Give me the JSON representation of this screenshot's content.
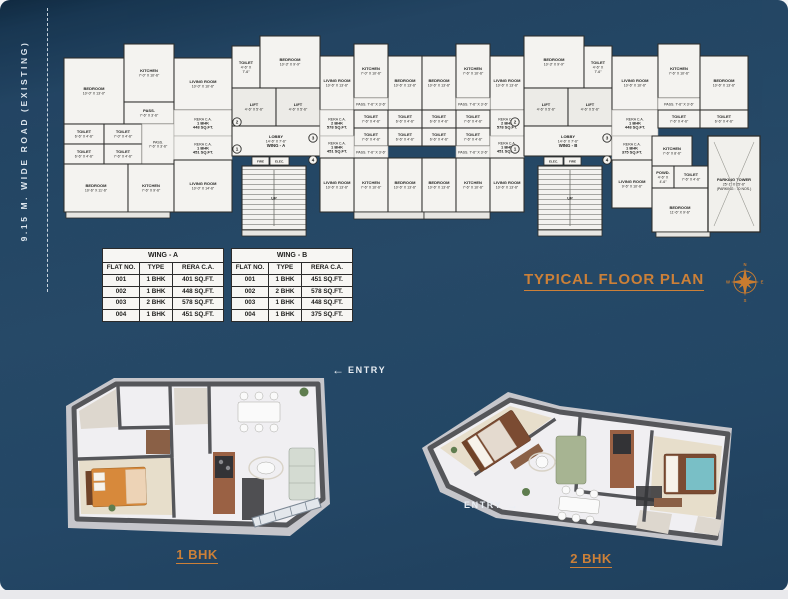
{
  "road": {
    "label": "9.15 M. WIDE ROAD (EXISTING)"
  },
  "plan": {
    "title": "TYPICAL FLOOR PLAN",
    "compass": {
      "n": "N",
      "e": "E",
      "s": "S",
      "w": "W"
    },
    "up_label": "UP",
    "service_boxes": [
      {
        "label": "FIRE",
        "x": 196,
        "y": 155,
        "w": 17,
        "h": 8
      },
      {
        "label": "ELEC.",
        "x": 214,
        "y": 155,
        "w": 19,
        "h": 8
      },
      {
        "label": "ELEC.",
        "x": 488,
        "y": 155,
        "w": 19,
        "h": 8
      },
      {
        "label": "FIRE",
        "x": 508,
        "y": 155,
        "w": 17,
        "h": 8
      }
    ],
    "markers": [
      {
        "n": "2",
        "x": 181,
        "y": 120
      },
      {
        "n": "1",
        "x": 181,
        "y": 147
      },
      {
        "n": "3",
        "x": 257,
        "y": 136
      },
      {
        "n": "4",
        "x": 257,
        "y": 158
      },
      {
        "n": "2",
        "x": 459,
        "y": 120
      },
      {
        "n": "1",
        "x": 459,
        "y": 147
      },
      {
        "n": "3",
        "x": 551,
        "y": 136
      },
      {
        "n": "4",
        "x": 551,
        "y": 158
      }
    ],
    "rooms": [
      {
        "x": 8,
        "y": 56,
        "w": 60,
        "h": 66,
        "lines": [
          "BEDROOM",
          "10'-0\" X 13'-0\""
        ]
      },
      {
        "x": 68,
        "y": 42,
        "w": 50,
        "h": 58,
        "lines": [
          "KITCHEN",
          "7'-0\" X 10'-6\""
        ]
      },
      {
        "x": 68,
        "y": 100,
        "w": 50,
        "h": 22,
        "lines": [
          "PASS.",
          "7'-6\" X 3'-6\""
        ]
      },
      {
        "x": 8,
        "y": 122,
        "w": 40,
        "h": 20,
        "lines": [
          "TOILET",
          "6'-6\" X 4'-6\""
        ]
      },
      {
        "x": 48,
        "y": 122,
        "w": 38,
        "h": 20,
        "lines": [
          "TOILET",
          "7'-0\" X 4'-6\""
        ]
      },
      {
        "x": 8,
        "y": 142,
        "w": 40,
        "h": 20,
        "lines": [
          "TOILET",
          "6'-6\" X 4'-6\""
        ]
      },
      {
        "x": 48,
        "y": 142,
        "w": 38,
        "h": 20,
        "lines": [
          "TOILET",
          "7'-6\" X 4'-6\""
        ]
      },
      {
        "x": 86,
        "y": 122,
        "w": 32,
        "h": 40,
        "lines": [
          "PASS.",
          "7'-6\" X 3'-6\""
        ],
        "cls": "pass"
      },
      {
        "x": 8,
        "y": 162,
        "w": 64,
        "h": 48,
        "lines": [
          "BEDROOM",
          "10'-6\" X 11'-6\""
        ]
      },
      {
        "x": 72,
        "y": 162,
        "w": 46,
        "h": 48,
        "lines": [
          "KITCHEN",
          "7'-6\" X 9'-6\""
        ]
      },
      {
        "x": 118,
        "y": 56,
        "w": 58,
        "h": 52,
        "lines": [
          "LIVING ROOM",
          "10'-0\" X 10'-6\""
        ]
      },
      {
        "x": 118,
        "y": 108,
        "w": 58,
        "h": 26,
        "lines": [
          "RERA C.A.",
          "1 BHK",
          "448 SQ.FT."
        ],
        "cls": "rera"
      },
      {
        "x": 118,
        "y": 134,
        "w": 58,
        "h": 24,
        "lines": [
          "RERA C.A.",
          "1 BHK",
          "451 SQ.FT."
        ],
        "cls": "rera"
      },
      {
        "x": 118,
        "y": 158,
        "w": 58,
        "h": 52,
        "lines": [
          "LIVING ROOM",
          "10'-0\" X 14'-6\""
        ]
      },
      {
        "x": 176,
        "y": 44,
        "w": 28,
        "h": 42,
        "lines": [
          "TOILET",
          "4'-6\" X",
          "7'-6\""
        ]
      },
      {
        "x": 204,
        "y": 34,
        "w": 60,
        "h": 52,
        "lines": [
          "BEDROOM",
          "10'-3\" X 9'-9\""
        ]
      },
      {
        "x": 176,
        "y": 86,
        "w": 44,
        "h": 38,
        "lines": [
          "LIFT",
          "4'-6\" X 5'-6\""
        ],
        "cls": "lift"
      },
      {
        "x": 220,
        "y": 86,
        "w": 44,
        "h": 38,
        "lines": [
          "LIFT",
          "4'-6\" X 5'-6\""
        ],
        "cls": "lift"
      },
      {
        "x": 176,
        "y": 124,
        "w": 88,
        "h": 30,
        "lines": [
          "LOBBY",
          "14'-6\" X 7'-6\"",
          "WING - A"
        ],
        "cls": "lobby"
      },
      {
        "x": 186,
        "y": 164,
        "w": 64,
        "h": 64,
        "cls": "stair"
      },
      {
        "x": 264,
        "y": 54,
        "w": 34,
        "h": 54,
        "lines": [
          "LIVING ROOM",
          "10'-6\" X 13'-6\""
        ]
      },
      {
        "x": 298,
        "y": 42,
        "w": 34,
        "h": 54,
        "lines": [
          "KITCHEN",
          "7'-0\" X 10'-6\""
        ]
      },
      {
        "x": 332,
        "y": 54,
        "w": 34,
        "h": 54,
        "lines": [
          "BEDROOM",
          "10'-6\" X 13'-6\""
        ]
      },
      {
        "x": 366,
        "y": 54,
        "w": 34,
        "h": 54,
        "lines": [
          "BEDROOM",
          "10'-6\" X 13'-6\""
        ]
      },
      {
        "x": 400,
        "y": 42,
        "w": 34,
        "h": 54,
        "lines": [
          "KITCHEN",
          "7'-6\" X 10'-6\""
        ]
      },
      {
        "x": 434,
        "y": 54,
        "w": 34,
        "h": 54,
        "lines": [
          "LIVING ROOM",
          "10'-6\" X 13'-6\""
        ]
      },
      {
        "x": 264,
        "y": 108,
        "w": 34,
        "h": 26,
        "lines": [
          "RERA C.A.",
          "2 BHK",
          "578 SQ.FT."
        ],
        "cls": "rera"
      },
      {
        "x": 434,
        "y": 108,
        "w": 34,
        "h": 26,
        "lines": [
          "RERA C.A.",
          "2 BHK",
          "578 SQ.FT."
        ],
        "cls": "rera"
      },
      {
        "x": 298,
        "y": 96,
        "w": 34,
        "h": 12,
        "lines": [
          "PASS. 7'-6\" X 3'-6\""
        ],
        "cls": "pass"
      },
      {
        "x": 400,
        "y": 96,
        "w": 34,
        "h": 12,
        "lines": [
          "PASS. 7'-6\" X 3'-6\""
        ],
        "cls": "pass"
      },
      {
        "x": 298,
        "y": 108,
        "w": 34,
        "h": 18,
        "lines": [
          "TOILET",
          "7'-6\" X 4'-6\""
        ]
      },
      {
        "x": 332,
        "y": 108,
        "w": 34,
        "h": 18,
        "lines": [
          "TOILET",
          "6'-6\" X 4'-6\""
        ]
      },
      {
        "x": 366,
        "y": 108,
        "w": 34,
        "h": 18,
        "lines": [
          "TOILET",
          "6'-6\" X 4'-6\""
        ]
      },
      {
        "x": 400,
        "y": 108,
        "w": 34,
        "h": 18,
        "lines": [
          "TOILET",
          "7'-6\" X 4'-6\""
        ]
      },
      {
        "x": 298,
        "y": 126,
        "w": 34,
        "h": 18,
        "lines": [
          "TOILET",
          "7'-6\" X 4'-6\""
        ]
      },
      {
        "x": 332,
        "y": 126,
        "w": 34,
        "h": 18,
        "lines": [
          "TOILET",
          "6'-6\" X 4'-6\""
        ]
      },
      {
        "x": 366,
        "y": 126,
        "w": 34,
        "h": 18,
        "lines": [
          "TOILET",
          "6'-6\" X 4'-6\""
        ]
      },
      {
        "x": 400,
        "y": 126,
        "w": 34,
        "h": 18,
        "lines": [
          "TOILET",
          "7'-6\" X 4'-6\""
        ]
      },
      {
        "x": 298,
        "y": 144,
        "w": 34,
        "h": 12,
        "lines": [
          "PASS. 7'-6\" X 3'-6\""
        ],
        "cls": "pass"
      },
      {
        "x": 400,
        "y": 144,
        "w": 34,
        "h": 12,
        "lines": [
          "PASS. 7'-6\" X 3'-6\""
        ],
        "cls": "pass"
      },
      {
        "x": 298,
        "y": 156,
        "w": 34,
        "h": 54,
        "lines": [
          "KITCHEN",
          "7'-6\" X 10'-6\""
        ]
      },
      {
        "x": 332,
        "y": 156,
        "w": 34,
        "h": 54,
        "lines": [
          "BEDROOM",
          "10'-6\" X 13'-6\""
        ]
      },
      {
        "x": 366,
        "y": 156,
        "w": 34,
        "h": 54,
        "lines": [
          "BEDROOM",
          "10'-6\" X 13'-6\""
        ]
      },
      {
        "x": 400,
        "y": 156,
        "w": 34,
        "h": 54,
        "lines": [
          "KITCHEN",
          "7'-6\" X 10'-6\""
        ]
      },
      {
        "x": 264,
        "y": 134,
        "w": 34,
        "h": 22,
        "lines": [
          "RERA C.A.",
          "1 BHK",
          "451 SQ.FT."
        ],
        "cls": "rera"
      },
      {
        "x": 264,
        "y": 156,
        "w": 34,
        "h": 54,
        "lines": [
          "LIVING ROOM",
          "10'-6\" X 13'-6\""
        ]
      },
      {
        "x": 434,
        "y": 134,
        "w": 34,
        "h": 22,
        "lines": [
          "RERA C.A.",
          "1 BHK",
          "451 SQ.FT."
        ],
        "cls": "rera"
      },
      {
        "x": 434,
        "y": 156,
        "w": 34,
        "h": 54,
        "lines": [
          "LIVING ROOM",
          "10'-6\" X 13'-6\""
        ]
      },
      {
        "x": 468,
        "y": 34,
        "w": 60,
        "h": 52,
        "lines": [
          "BEDROOM",
          "10'-3\" X 9'-9\""
        ]
      },
      {
        "x": 528,
        "y": 44,
        "w": 28,
        "h": 42,
        "lines": [
          "TOILET",
          "4'-6\" X",
          "7'-6\""
        ]
      },
      {
        "x": 468,
        "y": 86,
        "w": 44,
        "h": 38,
        "lines": [
          "LIFT",
          "4'-6\" X 5'-6\""
        ],
        "cls": "lift"
      },
      {
        "x": 512,
        "y": 86,
        "w": 44,
        "h": 38,
        "lines": [
          "LIFT",
          "4'-6\" X 5'-6\""
        ],
        "cls": "lift"
      },
      {
        "x": 468,
        "y": 124,
        "w": 88,
        "h": 30,
        "lines": [
          "LOBBY",
          "14'-6\" X 7'-6\"",
          "WING - B"
        ],
        "cls": "lobby"
      },
      {
        "x": 482,
        "y": 164,
        "w": 64,
        "h": 64,
        "cls": "stair"
      },
      {
        "x": 556,
        "y": 54,
        "w": 46,
        "h": 54,
        "lines": [
          "LIVING ROOM",
          "10'-6\" X 10'-6\""
        ]
      },
      {
        "x": 556,
        "y": 108,
        "w": 46,
        "h": 26,
        "lines": [
          "RERA C.A.",
          "1 BHK",
          "448 SQ.FT."
        ],
        "cls": "rera"
      },
      {
        "x": 602,
        "y": 42,
        "w": 42,
        "h": 54,
        "lines": [
          "KITCHEN",
          "7'-6\" X 10'-6\""
        ]
      },
      {
        "x": 602,
        "y": 96,
        "w": 42,
        "h": 12,
        "lines": [
          "PASS. 7'-6\" X 3'-6\""
        ],
        "cls": "pass"
      },
      {
        "x": 602,
        "y": 108,
        "w": 42,
        "h": 18,
        "lines": [
          "TOILET",
          "7'-6\" X 4'-6\""
        ]
      },
      {
        "x": 644,
        "y": 54,
        "w": 48,
        "h": 54,
        "lines": [
          "BEDROOM",
          "10'-6\" X 13'-6\""
        ]
      },
      {
        "x": 644,
        "y": 108,
        "w": 48,
        "h": 18,
        "lines": [
          "TOILET",
          "6'-6\" X 4'-6\""
        ]
      },
      {
        "x": 556,
        "y": 134,
        "w": 40,
        "h": 24,
        "lines": [
          "RERA C.A.",
          "1 BHK",
          "375 SQ.FT."
        ],
        "cls": "rera"
      },
      {
        "x": 596,
        "y": 134,
        "w": 40,
        "h": 30,
        "lines": [
          "KITCHEN",
          "7'-6\" X 8'-6\""
        ]
      },
      {
        "x": 596,
        "y": 164,
        "w": 22,
        "h": 22,
        "lines": [
          "POWD.",
          "4'-6\" X",
          "4'-6\""
        ]
      },
      {
        "x": 618,
        "y": 164,
        "w": 34,
        "h": 22,
        "lines": [
          "TOILET",
          "7'-6\" X 4'-6\""
        ]
      },
      {
        "x": 556,
        "y": 158,
        "w": 40,
        "h": 48,
        "lines": [
          "LIVING ROOM",
          "9'-6\" X 10'-6\""
        ]
      },
      {
        "x": 596,
        "y": 186,
        "w": 56,
        "h": 44,
        "lines": [
          "BEDROOM",
          "11'-6\" X 9'-6\""
        ]
      },
      {
        "x": 652,
        "y": 134,
        "w": 52,
        "h": 96,
        "lines": [
          "PARKING TOWER",
          "25'-1\" X 25'-6\"",
          "(PARKING : 70 NOS.)"
        ],
        "cls": "tower"
      },
      {
        "x": 10,
        "y": 210,
        "w": 104,
        "h": 6,
        "cls": "plinth"
      },
      {
        "x": 186,
        "y": 228,
        "w": 64,
        "h": 6,
        "cls": "plinth"
      },
      {
        "x": 298,
        "y": 210,
        "w": 70,
        "h": 7,
        "cls": "plinth"
      },
      {
        "x": 368,
        "y": 210,
        "w": 66,
        "h": 7,
        "cls": "plinth"
      },
      {
        "x": 482,
        "y": 228,
        "w": 64,
        "h": 6,
        "cls": "plinth"
      },
      {
        "x": 600,
        "y": 230,
        "w": 54,
        "h": 5,
        "cls": "plinth"
      }
    ]
  },
  "tables": [
    {
      "title": "WING - A",
      "headers": [
        "FLAT NO.",
        "TYPE",
        "RERA C.A."
      ],
      "rows": [
        [
          "001",
          "1 BHK",
          "401 SQ.FT."
        ],
        [
          "002",
          "1 BHK",
          "448 SQ.FT."
        ],
        [
          "003",
          "2 BHK",
          "578 SQ.FT."
        ],
        [
          "004",
          "1 BHK",
          "451 SQ.FT."
        ]
      ]
    },
    {
      "title": "WING - B",
      "headers": [
        "FLAT NO.",
        "TYPE",
        "RERA C.A."
      ],
      "rows": [
        [
          "001",
          "1 BHK",
          "451 SQ.FT."
        ],
        [
          "002",
          "2 BHK",
          "578 SQ.FT."
        ],
        [
          "003",
          "1 BHK",
          "448 SQ.FT."
        ],
        [
          "004",
          "1 BHK",
          "375 SQ.FT."
        ]
      ]
    }
  ],
  "units": [
    {
      "name": "1 BHK",
      "entry": "ENTRY",
      "arrow": "←"
    },
    {
      "name": "2 BHK",
      "entry": "ENTRY",
      "arrow": "→"
    }
  ],
  "colors": {
    "accent_orange": "#cc8038",
    "background_blue": "#2b5578",
    "plan_white": "#f4f3f0"
  }
}
